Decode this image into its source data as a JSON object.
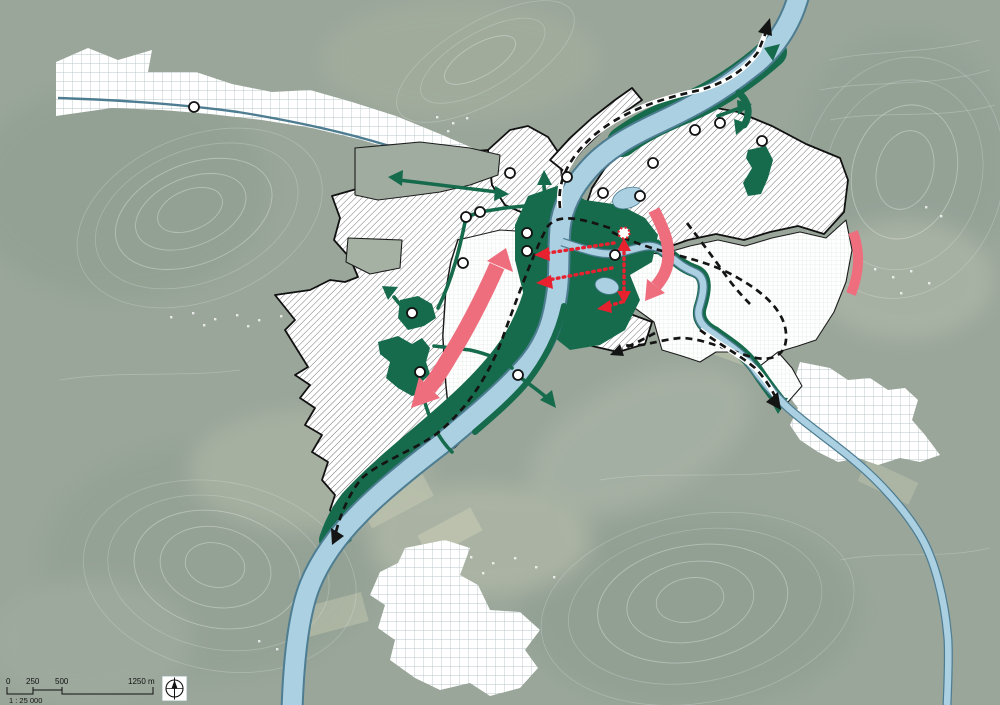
{
  "scalebar": {
    "tick_labels": [
      "0",
      "250",
      "500"
    ],
    "end_label": "1250 m",
    "scale_ratio": "1 : 25 000"
  },
  "icons": {
    "compass": "compass-rose-north-icon"
  },
  "colors": {
    "aerial_base": "#9aa69a",
    "water": "#abd0e2",
    "water_edge": "#4e7d92",
    "green_dark": "#176b4d",
    "pink": "#ee6e7e",
    "red": "#e8212f",
    "outline_black": "#111111",
    "grid_blue_line": "#b9c7cb",
    "grid_green_line": "#d3e3d8",
    "hatch_line": "#3f3f3f"
  }
}
